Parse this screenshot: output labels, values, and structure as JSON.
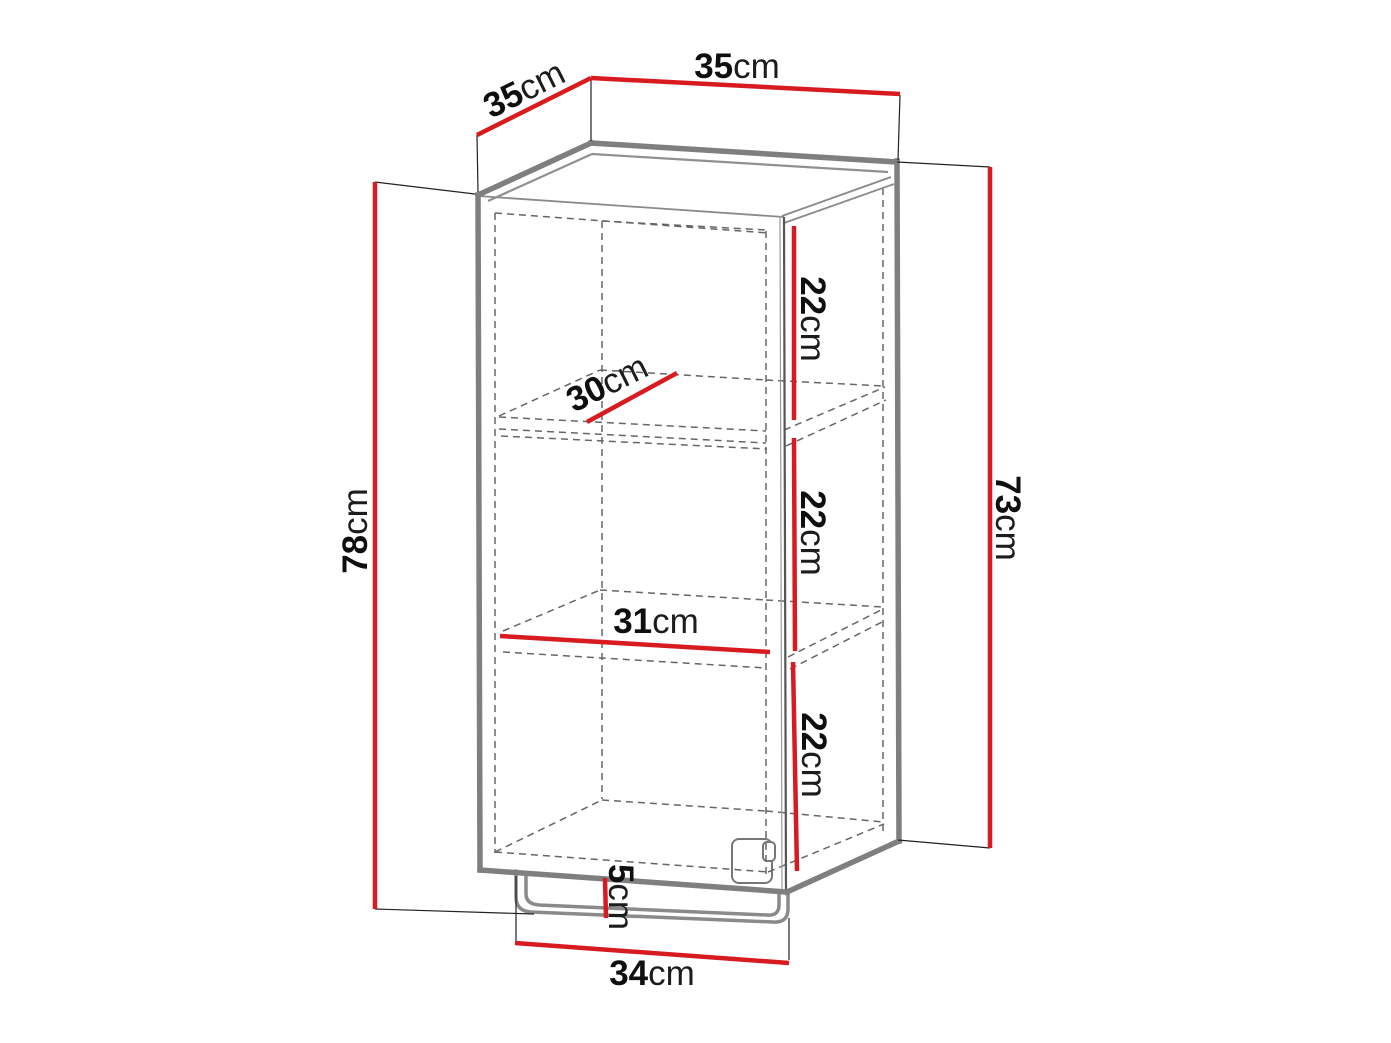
{
  "diagram": {
    "kind": "furniture-dimension-drawing",
    "object": "single-door wall cabinet with two shelves and bottom rail"
  },
  "colors": {
    "accent": "#d81b21",
    "outline": "#7f7f7f",
    "hidden": "#666666",
    "ink": "#0f0f0f",
    "bg": "#ffffff"
  },
  "dims": {
    "depth_top": {
      "value": "35",
      "unit": "cm"
    },
    "width_top": {
      "value": "35",
      "unit": "cm"
    },
    "height_total": {
      "value": "78",
      "unit": "cm"
    },
    "height_body": {
      "value": "73",
      "unit": "cm"
    },
    "section_top": {
      "value": "22",
      "unit": "cm"
    },
    "section_middle": {
      "value": "22",
      "unit": "cm"
    },
    "section_bottom": {
      "value": "22",
      "unit": "cm"
    },
    "shelf_depth": {
      "value": "30",
      "unit": "cm"
    },
    "shelf_width": {
      "value": "31",
      "unit": "cm"
    },
    "rail_gap": {
      "value": "5",
      "unit": "cm"
    },
    "rail_width": {
      "value": "34",
      "unit": "cm"
    }
  }
}
